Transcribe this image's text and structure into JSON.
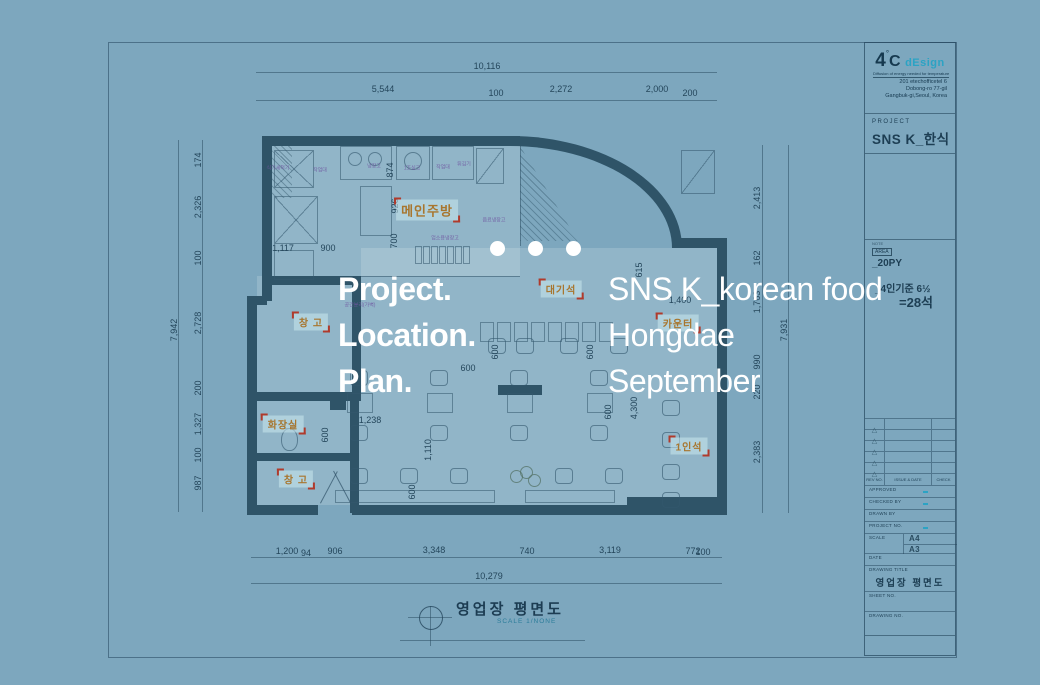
{
  "colors": {
    "background": "#7da7be",
    "wall": "#2f5468",
    "navy": "#16394f",
    "teal": "#2ba3c4",
    "label_orange": "#a8762e",
    "bracket_red": "#b03a2c",
    "white": "#ffffff"
  },
  "overlay": {
    "left_lines": [
      "Project.",
      "Location.",
      "Plan."
    ],
    "right_lines": [
      "SNS K_korean food",
      "Hongdae",
      "September"
    ],
    "dot_count": 3
  },
  "plan": {
    "caption": {
      "title": "영업장 평면도",
      "scale": "SCALE 1/NONE"
    },
    "dim_labels": [
      {
        "t": "10,116",
        "x": 487,
        "y": 66
      },
      {
        "t": "5,544",
        "x": 383,
        "y": 89
      },
      {
        "t": "100",
        "x": 496,
        "y": 93
      },
      {
        "t": "2,272",
        "x": 561,
        "y": 89
      },
      {
        "t": "2,000",
        "x": 657,
        "y": 89
      },
      {
        "t": "200",
        "x": 690,
        "y": 93
      },
      {
        "t": "174",
        "x": 198,
        "y": 160,
        "r": 1
      },
      {
        "t": "2,326",
        "x": 198,
        "y": 207,
        "r": 1
      },
      {
        "t": "100",
        "x": 198,
        "y": 258,
        "r": 1
      },
      {
        "t": "2,728",
        "x": 198,
        "y": 323,
        "r": 1
      },
      {
        "t": "7,942",
        "x": 174,
        "y": 330,
        "r": 1
      },
      {
        "t": "200",
        "x": 198,
        "y": 388,
        "r": 1
      },
      {
        "t": "1,327",
        "x": 198,
        "y": 424,
        "r": 1
      },
      {
        "t": "100",
        "x": 198,
        "y": 455,
        "r": 1
      },
      {
        "t": "987",
        "x": 198,
        "y": 483,
        "r": 1
      },
      {
        "t": "2,413",
        "x": 757,
        "y": 198,
        "r": 1
      },
      {
        "t": "162",
        "x": 757,
        "y": 258,
        "r": 1
      },
      {
        "t": "1,763",
        "x": 757,
        "y": 302,
        "r": 1
      },
      {
        "t": "7,931",
        "x": 784,
        "y": 330,
        "r": 1
      },
      {
        "t": "990",
        "x": 757,
        "y": 362,
        "r": 1
      },
      {
        "t": "220",
        "x": 757,
        "y": 392,
        "r": 1
      },
      {
        "t": "2,383",
        "x": 757,
        "y": 452,
        "r": 1
      },
      {
        "t": "1,200",
        "x": 287,
        "y": 551
      },
      {
        "t": "94",
        "x": 306,
        "y": 553
      },
      {
        "t": "906",
        "x": 335,
        "y": 551
      },
      {
        "t": "3,348",
        "x": 434,
        "y": 550
      },
      {
        "t": "740",
        "x": 527,
        "y": 551
      },
      {
        "t": "3,119",
        "x": 610,
        "y": 550
      },
      {
        "t": "772",
        "x": 693,
        "y": 551
      },
      {
        "t": "100",
        "x": 703,
        "y": 552
      },
      {
        "t": "10,279",
        "x": 489,
        "y": 576
      },
      {
        "t": "1,117",
        "x": 283,
        "y": 248
      },
      {
        "t": "900",
        "x": 328,
        "y": 248
      },
      {
        "t": "874",
        "x": 390,
        "y": 170,
        "r": 1
      },
      {
        "t": "926",
        "x": 395,
        "y": 206,
        "r": 1
      },
      {
        "t": "700",
        "x": 394,
        "y": 241,
        "r": 1
      },
      {
        "t": "1,238",
        "x": 370,
        "y": 420
      },
      {
        "t": "1,110",
        "x": 428,
        "y": 450,
        "r": 1
      },
      {
        "t": "4,300",
        "x": 634,
        "y": 408,
        "r": 1
      },
      {
        "t": "615",
        "x": 639,
        "y": 270,
        "r": 1
      },
      {
        "t": "1,400",
        "x": 680,
        "y": 300
      },
      {
        "t": "600",
        "x": 495,
        "y": 352,
        "r": 1
      },
      {
        "t": "600",
        "x": 590,
        "y": 352,
        "r": 1
      },
      {
        "t": "600",
        "x": 325,
        "y": 435,
        "r": 1
      },
      {
        "t": "600",
        "x": 468,
        "y": 368
      },
      {
        "t": "600",
        "x": 608,
        "y": 412,
        "r": 1
      },
      {
        "t": "600",
        "x": 412,
        "y": 492,
        "r": 1
      }
    ],
    "room_labels": [
      {
        "t": "메인주방",
        "x": 427,
        "y": 210,
        "s": 13
      },
      {
        "t": "대기석",
        "x": 561,
        "y": 289
      },
      {
        "t": "카운터",
        "x": 678,
        "y": 323
      },
      {
        "t": "창 고",
        "x": 311,
        "y": 322
      },
      {
        "t": "화장실",
        "x": 283,
        "y": 424
      },
      {
        "t": "창 고",
        "x": 296,
        "y": 479
      },
      {
        "t": "1인석",
        "x": 689,
        "y": 446
      }
    ],
    "equip_labels": [
      {
        "t": "식기세척기",
        "x": 278,
        "y": 168
      },
      {
        "t": "작업대",
        "x": 320,
        "y": 170
      },
      {
        "t": "냉장고",
        "x": 374,
        "y": 166
      },
      {
        "t": "1조싱크",
        "x": 412,
        "y": 168
      },
      {
        "t": "작업대",
        "x": 443,
        "y": 167
      },
      {
        "t": "튀김기",
        "x": 464,
        "y": 164
      },
      {
        "t": "음료냉장고",
        "x": 494,
        "y": 220
      },
      {
        "t": "업소용냉장고",
        "x": 445,
        "y": 238
      },
      {
        "t": "공간분리(가벽)",
        "x": 360,
        "y": 305
      }
    ]
  },
  "title_block": {
    "logo_4": "4",
    "logo_degree": "°",
    "logo_c": "C",
    "logo_design": "dEsign",
    "tagline": "Diffusion of energy needed for temperature",
    "address": [
      "201 etechofficetel 6",
      "Dobong-ro 77-gil",
      "Gangbuk-gi,Seoul, Korea"
    ],
    "project_label": "PROJECT",
    "project_name": "SNS K_한식",
    "note_label": "NOTE",
    "area_label": "AREA",
    "area_value": "_20PY",
    "capacity_line1": "_4인기준 6½",
    "capacity_line2": "=28석",
    "rev_header": {
      "col1": "REV NO.",
      "col2": "ISSUE & DATE",
      "col3": "CHECK"
    },
    "rev_row_count": 5,
    "info_rows": [
      {
        "label": "APPROVED"
      },
      {
        "label": "CHECKED BY"
      },
      {
        "label": "DRAWN BY"
      },
      {
        "label": "PROJECT NO."
      }
    ],
    "scale_label": "SCALE",
    "paper_sizes": [
      "A4",
      "A3"
    ],
    "date_label": "DATE",
    "drawing_title_label": "DRAWING TITLE",
    "drawing_title_value": "영업장 평면도",
    "sheet_label": "SHEET NO.",
    "drawing_no_label": "DRAWING NO."
  }
}
